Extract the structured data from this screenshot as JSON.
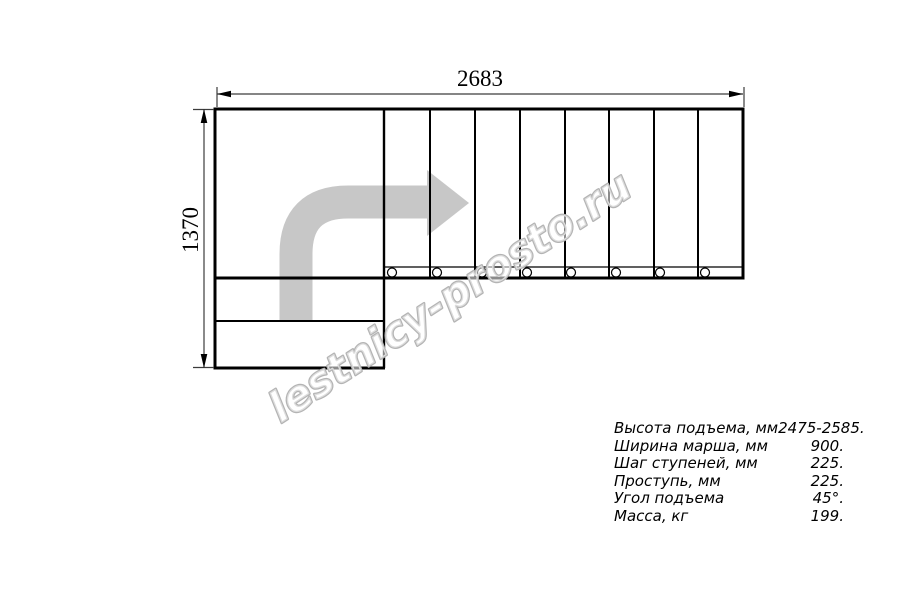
{
  "dimensions": {
    "width_mm": "2683",
    "height_mm": "1370"
  },
  "watermark": {
    "text": "lestnicy-prosto.ru"
  },
  "specs": {
    "rows": [
      {
        "label": "Высота подъема, мм",
        "value": "2475-2585."
      },
      {
        "label": "Ширина марша, мм",
        "value": "900."
      },
      {
        "label": "Шаг ступеней, мм",
        "value": "225."
      },
      {
        "label": "Проступь, мм",
        "value": "225."
      },
      {
        "label": "Угол подъема",
        "value": "45°."
      },
      {
        "label": "Масса, кг",
        "value": "199."
      }
    ]
  },
  "colors": {
    "line": "#000000",
    "dimension_line": "#3c3c3c",
    "arrow_fill": "#c7c7c7",
    "watermark_outline": "#b4b4b4",
    "watermark_fill": "rgba(255,255,255,0.55)",
    "background": "#ffffff"
  }
}
